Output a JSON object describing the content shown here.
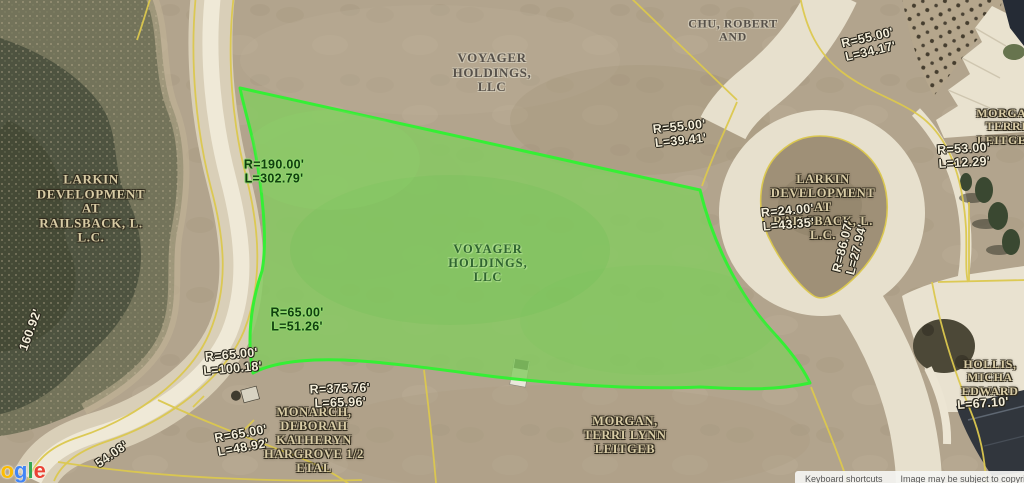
{
  "map": {
    "highlight_color": "#35ef35",
    "parcel_line_color": "#dcc84e",
    "parcels": {
      "voyager_top": {
        "lines": [
          "VOYAGER",
          "HOLDINGS,",
          "LLC"
        ]
      },
      "chu": {
        "lines": [
          "CHU, ROBERT",
          "AND"
        ]
      },
      "larkin_pond": {
        "lines": [
          "LARKIN",
          "DEVELOPMENT",
          "AT",
          "RAILSBACK, L.",
          "L.C."
        ]
      },
      "voyager_green": {
        "lines": [
          "VOYAGER",
          "HOLDINGS,",
          "LLC"
        ]
      },
      "larkin_island": {
        "lines": [
          "LARKIN",
          "DEVELOPMENT",
          "AT",
          "RAILSBACK, L.",
          "L.C."
        ]
      },
      "monarch": {
        "lines": [
          "MONARCH,",
          "DEBORAH",
          "KATHERYN",
          "HARGROVE 1/2",
          "ETAL"
        ]
      },
      "morgan_bottom": {
        "lines": [
          "MORGAN,",
          "TERRI LYNN",
          "LEITGEB"
        ]
      },
      "morgan_right": {
        "lines": [
          "MORGAN",
          "TERRI",
          "LEITGEB"
        ]
      },
      "hollis": {
        "lines": [
          "HOLLIS,",
          "MICHA",
          "EDWARD"
        ]
      }
    },
    "measurements": {
      "r190": {
        "lines": [
          "R=190.00'",
          "L=302.79'"
        ]
      },
      "r55_39": {
        "lines": [
          "R=55.00'",
          "L=39.41'"
        ]
      },
      "r55_34": {
        "lines": [
          "R=55.00'",
          "L=34.17'"
        ]
      },
      "r65_51": {
        "lines": [
          "R=65.00'",
          "L=51.26'"
        ]
      },
      "r65_100": {
        "lines": [
          "R=65.00'",
          "L=100.18'"
        ]
      },
      "r65_48": {
        "lines": [
          "R=65.00'",
          "L=48.92'"
        ]
      },
      "r375": {
        "lines": [
          "R=375.76'",
          "L=65.96'"
        ]
      },
      "r24": {
        "lines": [
          "R=24.00'",
          "L=43.35'"
        ]
      },
      "r86": {
        "lines": [
          "R=86.07'",
          "L=27.94'"
        ]
      },
      "r53": {
        "lines": [
          "R=53.00'",
          "L=12.29'"
        ]
      },
      "l67": {
        "lines": [
          "L=67.10'"
        ]
      },
      "d54": "54.08'",
      "d160": "160.92'"
    }
  },
  "watermark": {
    "letters": [
      {
        "ch": "G",
        "color": "#4285f4"
      },
      {
        "ch": "o",
        "color": "#ea4335"
      },
      {
        "ch": "o",
        "color": "#fbbc05"
      },
      {
        "ch": "g",
        "color": "#4285f4"
      },
      {
        "ch": "l",
        "color": "#34a853"
      },
      {
        "ch": "e",
        "color": "#ea4335"
      }
    ]
  },
  "footer": {
    "keyboard_shortcuts": "Keyboard shortcuts",
    "copyright": "Image may be subject to copyri"
  }
}
